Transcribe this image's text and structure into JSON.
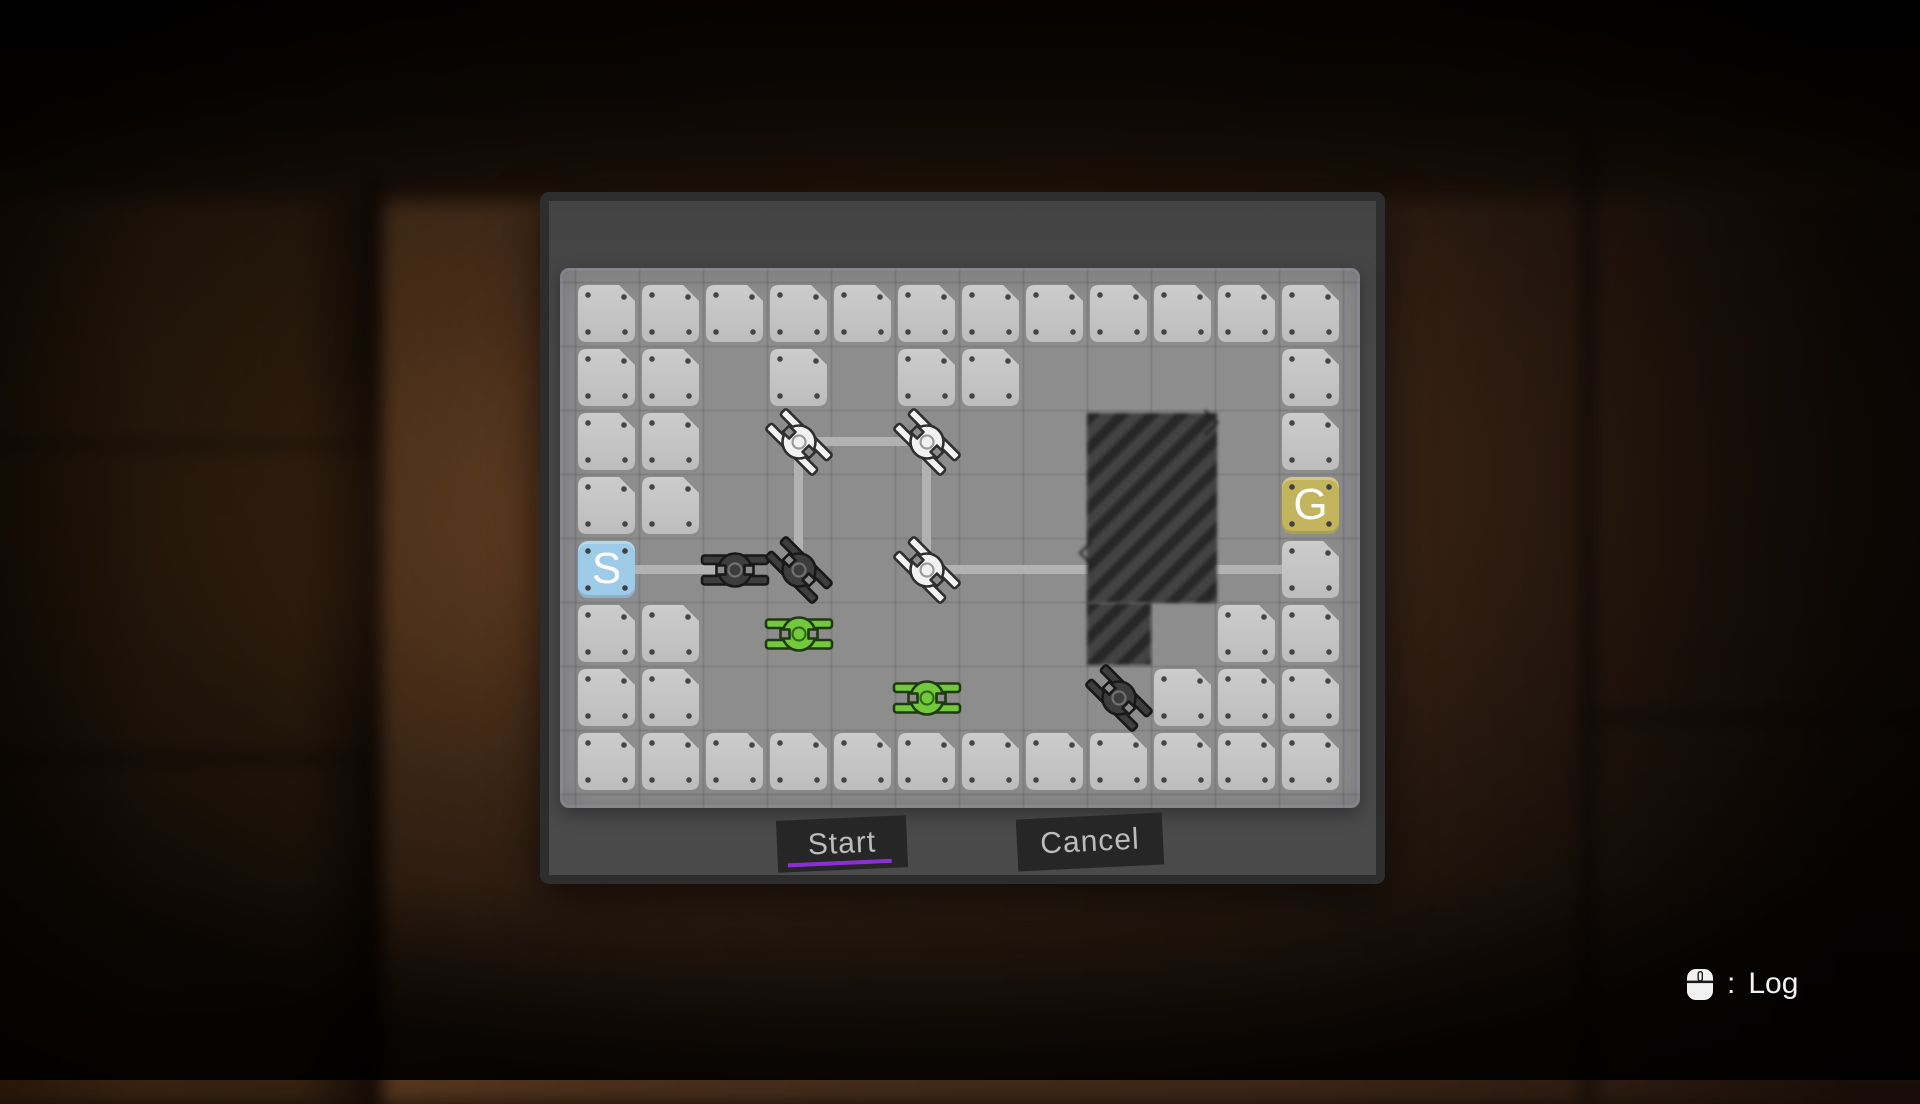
{
  "palette": {
    "panel": "#484848",
    "panel_border": "#2d2d2d",
    "board_bg": "#8d8d8d",
    "tile_light": "#cccccc",
    "tile_dark": "#bdbdbd",
    "connector_line": "#b2b2b2",
    "hatch_dark": "#272727",
    "hatch_light": "#424242",
    "start_tile": "#9ecbe7",
    "goal_tile": "#c2b55e",
    "button_bg": "#262626",
    "button_text": "#bcbcbc",
    "start_underline": "#8b2fd2",
    "hud_text": "#f2f2f2",
    "turret_styles": {
      "white": {
        "fill": "#f2f2f2",
        "outline": "#2e2e2e",
        "ring": "#9a9a9a"
      },
      "black": {
        "fill": "#3d3d3d",
        "outline": "#181818",
        "ring": "#707070"
      },
      "green": {
        "fill": "#73c83e",
        "outline": "#1e3a0e",
        "ring": "#2f6b16"
      }
    }
  },
  "dialog": {
    "start_label": "Start",
    "cancel_label": "Cancel"
  },
  "hud": {
    "mouse_icon": "mouse-icon",
    "separator": ":",
    "log_label": "Log"
  },
  "board": {
    "position": {
      "x": 560,
      "y": 268,
      "w": 800,
      "h": 540
    },
    "origin": {
      "x": 578,
      "y": 285
    },
    "cell": 64,
    "tile": 57,
    "cols": 12,
    "rows": 8,
    "grid": [
      "111111111111",
      "110101100001",
      "110000000001",
      "110000000000",
      "000000000001",
      "110000000011",
      "110000000111",
      "111111111111"
    ],
    "special_tiles": [
      {
        "id": "start",
        "label": "S",
        "col": 1,
        "row": 5
      },
      {
        "id": "goal",
        "label": "G",
        "col": 12,
        "row": 4
      }
    ],
    "turrets": [
      {
        "color": "white",
        "col": 4,
        "row": 3,
        "rot": 45
      },
      {
        "color": "white",
        "col": 6,
        "row": 3,
        "rot": 45
      },
      {
        "color": "white",
        "col": 6,
        "row": 5,
        "rot": 45
      },
      {
        "color": "black",
        "col": 3,
        "row": 5,
        "rot": 0
      },
      {
        "color": "black",
        "col": 4,
        "row": 5,
        "rot": 45
      },
      {
        "color": "black",
        "col": 9,
        "row": 7,
        "rot": 45
      },
      {
        "color": "green",
        "col": 4,
        "row": 6,
        "rot": 0
      },
      {
        "color": "green",
        "col": 6,
        "row": 7,
        "rot": 0
      }
    ],
    "lines": [
      {
        "from": [
          1,
          5
        ],
        "to": [
          3,
          5
        ]
      },
      {
        "from": [
          4,
          3
        ],
        "to": [
          4,
          5
        ]
      },
      {
        "from": [
          4,
          3
        ],
        "to": [
          6,
          3
        ]
      },
      {
        "from": [
          6,
          3
        ],
        "to": [
          6,
          5
        ]
      },
      {
        "from": [
          6,
          5
        ],
        "to": [
          12,
          5
        ]
      }
    ],
    "line_thickness": 9,
    "hatch_rects": [
      {
        "x": 1087,
        "y": 413,
        "w": 130,
        "h": 190,
        "marks": true
      },
      {
        "x": 1087,
        "y": 603,
        "w": 64,
        "h": 62,
        "marks": false
      }
    ]
  }
}
